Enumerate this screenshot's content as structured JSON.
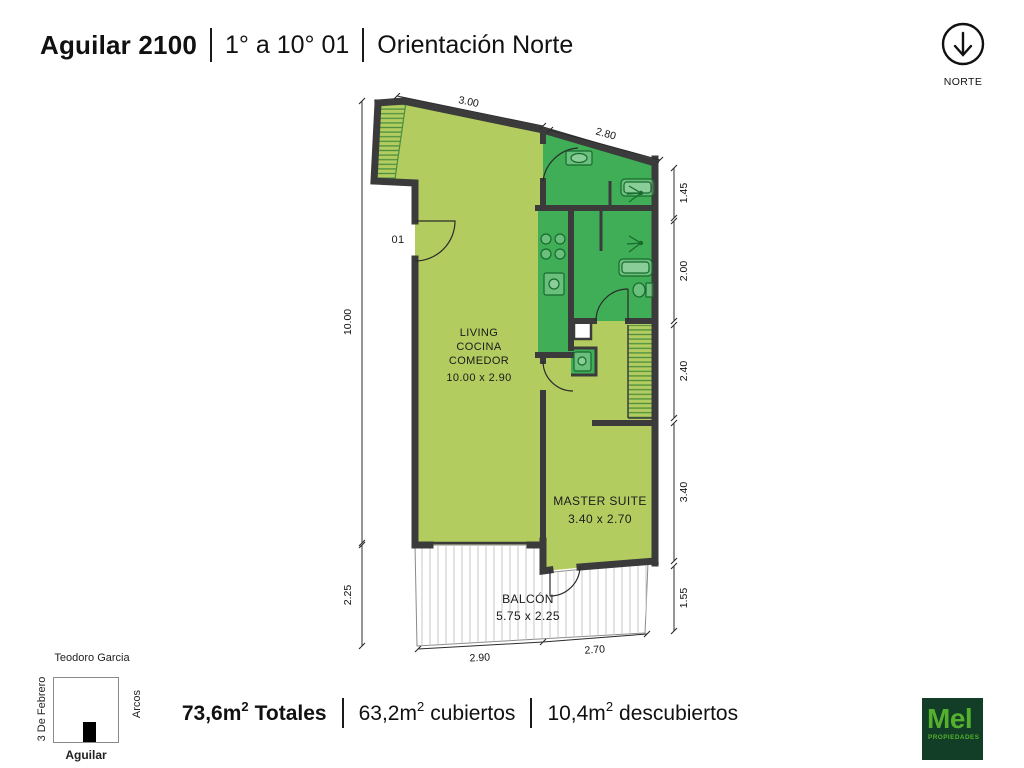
{
  "header": {
    "title": "Aguilar 2100",
    "floors": "1° a 10° 01",
    "orientation": "Orientación Norte"
  },
  "north": {
    "label": "NORTE"
  },
  "plan": {
    "unit_number": "01",
    "rooms": {
      "living": {
        "line1": "LIVING",
        "line2": "COCINA",
        "line3": "COMEDOR",
        "dims": "10.00 x 2.90"
      },
      "master": {
        "name": "MASTER SUITE",
        "dims": "3.40 x 2.70"
      },
      "balcony": {
        "name": "BALCÓN",
        "dims": "5.75 x 2.25"
      }
    },
    "dimensions": {
      "top_left": "3.00",
      "top_right": "2.80",
      "right": [
        "1.45",
        "2.00",
        "2.40",
        "3.40",
        "1.55"
      ],
      "left": [
        "10.00",
        "2.25"
      ],
      "bottom": [
        "2.90",
        "2.70"
      ]
    },
    "colors": {
      "covered": "#b3cc60",
      "wet": "#3fae57",
      "wall": "#3b3b3b",
      "hatch": "#4c8f3f"
    }
  },
  "map": {
    "street_top": "Teodoro Garcia",
    "street_left": "3 De Febrero",
    "street_right": "Arcos",
    "street_bottom": "Aguilar"
  },
  "totals": [
    {
      "value": "73,6m",
      "sup": "2",
      "label": "Totales"
    },
    {
      "value": "63,2m",
      "sup": "2",
      "label": "cubiertos"
    },
    {
      "value": "10,4m",
      "sup": "2",
      "label": "descubiertos"
    }
  ],
  "logo": {
    "name": "Mel",
    "subtitle": "PROPIEDADES",
    "bg": "#123d27",
    "fg": "#55b02e"
  }
}
